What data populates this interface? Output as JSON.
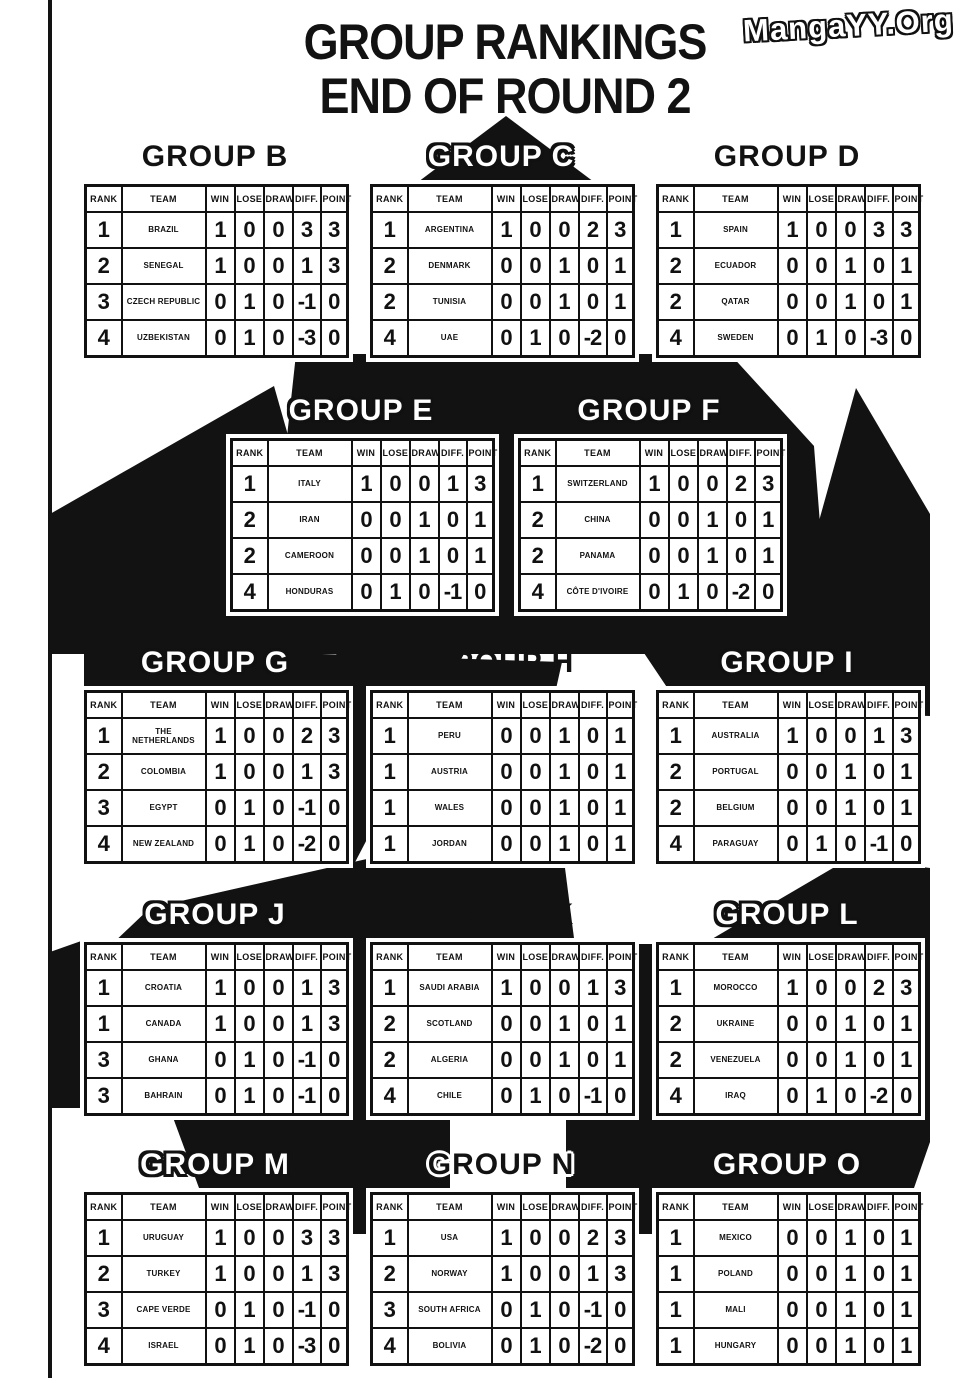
{
  "page_title_line1": "GROUP RANKINGS",
  "page_title_line2": "END OF ROUND 2",
  "watermark": "MangaYY.Org",
  "colors": {
    "ink": "#121212",
    "paper": "#ffffff"
  },
  "table_headers": [
    "RANK",
    "TEAM",
    "WIN",
    "LOSE",
    "DRAW",
    "DIFF.",
    "POINT"
  ],
  "groups": [
    {
      "name": "GROUP B",
      "teams": [
        [
          "1",
          "BRAZIL",
          "1",
          "0",
          "0",
          "3",
          "3"
        ],
        [
          "2",
          "SENEGAL",
          "1",
          "0",
          "0",
          "1",
          "3"
        ],
        [
          "3",
          "CZECH REPUBLIC",
          "0",
          "1",
          "0",
          "-1",
          "0"
        ],
        [
          "4",
          "UZBEKISTAN",
          "0",
          "1",
          "0",
          "-3",
          "0"
        ]
      ]
    },
    {
      "name": "GROUP C",
      "teams": [
        [
          "1",
          "ARGENTINA",
          "1",
          "0",
          "0",
          "2",
          "3"
        ],
        [
          "2",
          "DENMARK",
          "0",
          "0",
          "1",
          "0",
          "1"
        ],
        [
          "2",
          "TUNISIA",
          "0",
          "0",
          "1",
          "0",
          "1"
        ],
        [
          "4",
          "UAE",
          "0",
          "1",
          "0",
          "-2",
          "0"
        ]
      ]
    },
    {
      "name": "GROUP D",
      "teams": [
        [
          "1",
          "SPAIN",
          "1",
          "0",
          "0",
          "3",
          "3"
        ],
        [
          "2",
          "ECUADOR",
          "0",
          "0",
          "1",
          "0",
          "1"
        ],
        [
          "2",
          "QATAR",
          "0",
          "0",
          "1",
          "0",
          "1"
        ],
        [
          "4",
          "SWEDEN",
          "0",
          "1",
          "0",
          "-3",
          "0"
        ]
      ]
    },
    {
      "name": "GROUP E",
      "teams": [
        [
          "1",
          "ITALY",
          "1",
          "0",
          "0",
          "1",
          "3"
        ],
        [
          "2",
          "IRAN",
          "0",
          "0",
          "1",
          "0",
          "1"
        ],
        [
          "2",
          "CAMEROON",
          "0",
          "0",
          "1",
          "0",
          "1"
        ],
        [
          "4",
          "HONDURAS",
          "0",
          "1",
          "0",
          "-1",
          "0"
        ]
      ]
    },
    {
      "name": "GROUP F",
      "teams": [
        [
          "1",
          "SWITZERLAND",
          "1",
          "0",
          "0",
          "2",
          "3"
        ],
        [
          "2",
          "CHINA",
          "0",
          "0",
          "1",
          "0",
          "1"
        ],
        [
          "2",
          "PANAMA",
          "0",
          "0",
          "1",
          "0",
          "1"
        ],
        [
          "4",
          "CÔTE D'IVOIRE",
          "0",
          "1",
          "0",
          "-2",
          "0"
        ]
      ]
    },
    {
      "name": "GROUP G",
      "teams": [
        [
          "1",
          "THE NETHERLANDS",
          "1",
          "0",
          "0",
          "2",
          "3"
        ],
        [
          "2",
          "COLOMBIA",
          "1",
          "0",
          "0",
          "1",
          "3"
        ],
        [
          "3",
          "EGYPT",
          "0",
          "1",
          "0",
          "-1",
          "0"
        ],
        [
          "4",
          "NEW ZEALAND",
          "0",
          "1",
          "0",
          "-2",
          "0"
        ]
      ]
    },
    {
      "name": "GROUP H",
      "teams": [
        [
          "1",
          "PERU",
          "0",
          "0",
          "1",
          "0",
          "1"
        ],
        [
          "1",
          "AUSTRIA",
          "0",
          "0",
          "1",
          "0",
          "1"
        ],
        [
          "1",
          "WALES",
          "0",
          "0",
          "1",
          "0",
          "1"
        ],
        [
          "1",
          "JORDAN",
          "0",
          "0",
          "1",
          "0",
          "1"
        ]
      ]
    },
    {
      "name": "GROUP I",
      "teams": [
        [
          "1",
          "AUSTRALIA",
          "1",
          "0",
          "0",
          "1",
          "3"
        ],
        [
          "2",
          "PORTUGAL",
          "0",
          "0",
          "1",
          "0",
          "1"
        ],
        [
          "2",
          "BELGIUM",
          "0",
          "0",
          "1",
          "0",
          "1"
        ],
        [
          "4",
          "PARAGUAY",
          "0",
          "1",
          "0",
          "-1",
          "0"
        ]
      ]
    },
    {
      "name": "GROUP J",
      "teams": [
        [
          "1",
          "CROATIA",
          "1",
          "0",
          "0",
          "1",
          "3"
        ],
        [
          "1",
          "CANADA",
          "1",
          "0",
          "0",
          "1",
          "3"
        ],
        [
          "3",
          "GHANA",
          "0",
          "1",
          "0",
          "-1",
          "0"
        ],
        [
          "3",
          "BAHRAIN",
          "0",
          "1",
          "0",
          "-1",
          "0"
        ]
      ]
    },
    {
      "name": "GROUP K",
      "teams": [
        [
          "1",
          "SAUDI ARABIA",
          "1",
          "0",
          "0",
          "1",
          "3"
        ],
        [
          "2",
          "SCOTLAND",
          "0",
          "0",
          "1",
          "0",
          "1"
        ],
        [
          "2",
          "ALGERIA",
          "0",
          "0",
          "1",
          "0",
          "1"
        ],
        [
          "4",
          "CHILE",
          "0",
          "1",
          "0",
          "-1",
          "0"
        ]
      ]
    },
    {
      "name": "GROUP L",
      "teams": [
        [
          "1",
          "MOROCCO",
          "1",
          "0",
          "0",
          "2",
          "3"
        ],
        [
          "2",
          "UKRAINE",
          "0",
          "0",
          "1",
          "0",
          "1"
        ],
        [
          "2",
          "VENEZUELA",
          "0",
          "0",
          "1",
          "0",
          "1"
        ],
        [
          "4",
          "IRAQ",
          "0",
          "1",
          "0",
          "-2",
          "0"
        ]
      ]
    },
    {
      "name": "GROUP M",
      "teams": [
        [
          "1",
          "URUGUAY",
          "1",
          "0",
          "0",
          "3",
          "3"
        ],
        [
          "2",
          "TURKEY",
          "1",
          "0",
          "0",
          "1",
          "3"
        ],
        [
          "3",
          "CAPE VERDE",
          "0",
          "1",
          "0",
          "-1",
          "0"
        ],
        [
          "4",
          "ISRAEL",
          "0",
          "1",
          "0",
          "-3",
          "0"
        ]
      ]
    },
    {
      "name": "GROUP N",
      "teams": [
        [
          "1",
          "USA",
          "1",
          "0",
          "0",
          "2",
          "3"
        ],
        [
          "2",
          "NORWAY",
          "1",
          "0",
          "0",
          "1",
          "3"
        ],
        [
          "3",
          "SOUTH AFRICA",
          "0",
          "1",
          "0",
          "-1",
          "0"
        ],
        [
          "4",
          "BOLIVIA",
          "0",
          "1",
          "0",
          "-2",
          "0"
        ]
      ]
    },
    {
      "name": "GROUP O",
      "teams": [
        [
          "1",
          "MEXICO",
          "0",
          "0",
          "1",
          "0",
          "1"
        ],
        [
          "1",
          "POLAND",
          "0",
          "0",
          "1",
          "0",
          "1"
        ],
        [
          "1",
          "MALI",
          "0",
          "0",
          "1",
          "0",
          "1"
        ],
        [
          "1",
          "HUNGARY",
          "0",
          "0",
          "1",
          "0",
          "1"
        ]
      ]
    }
  ]
}
